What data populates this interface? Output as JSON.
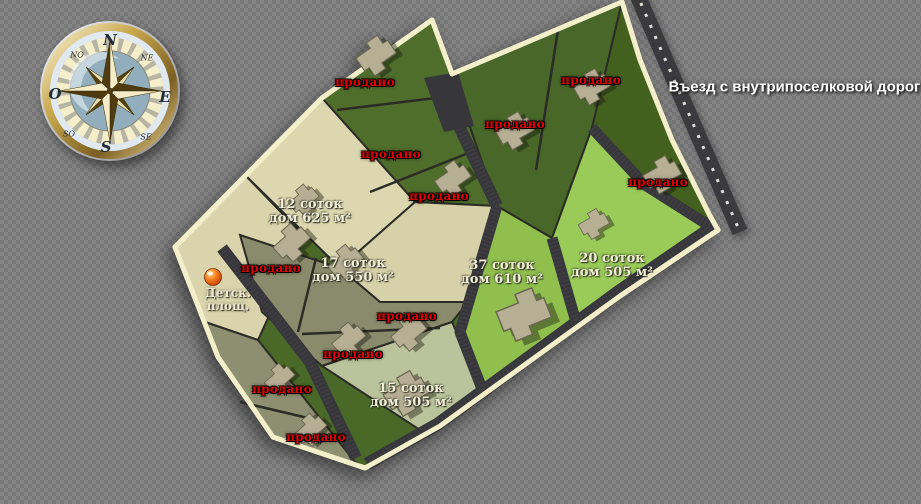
{
  "entrance": {
    "label": "Въезд с внутрипоселковой дороги"
  },
  "sold": {
    "label": "продано",
    "count": 11
  },
  "plots": {
    "available": [
      {
        "id": "plot-12",
        "area": "12 соток",
        "house": "дом 625 м²"
      },
      {
        "id": "plot-17",
        "area": "17 соток",
        "house": "дом 550 м²"
      },
      {
        "id": "plot-37",
        "area": "37 соток",
        "house": "дом 610 м²"
      },
      {
        "id": "plot-20",
        "area": "20 соток",
        "house": "дом 505 м²"
      },
      {
        "id": "plot-15",
        "area": "15 соток",
        "house": "дом 505 м²"
      }
    ]
  },
  "playground": {
    "label": "Детск.\nплощ."
  },
  "compass": {
    "n": "N",
    "e": "E",
    "s": "S",
    "w": "O",
    "ne": "NE",
    "nw": "NO",
    "se": "SE",
    "sw": "SO"
  },
  "colors": {
    "sold_text": "#e20000",
    "boundary": "#f4efcb",
    "dark_green": "#4a6827",
    "bright_green": "#92c04f",
    "pale_green": "#bac39b",
    "beige": "#dcd7af",
    "olive": "#8b8b6d",
    "road": "#3a3a3e"
  }
}
